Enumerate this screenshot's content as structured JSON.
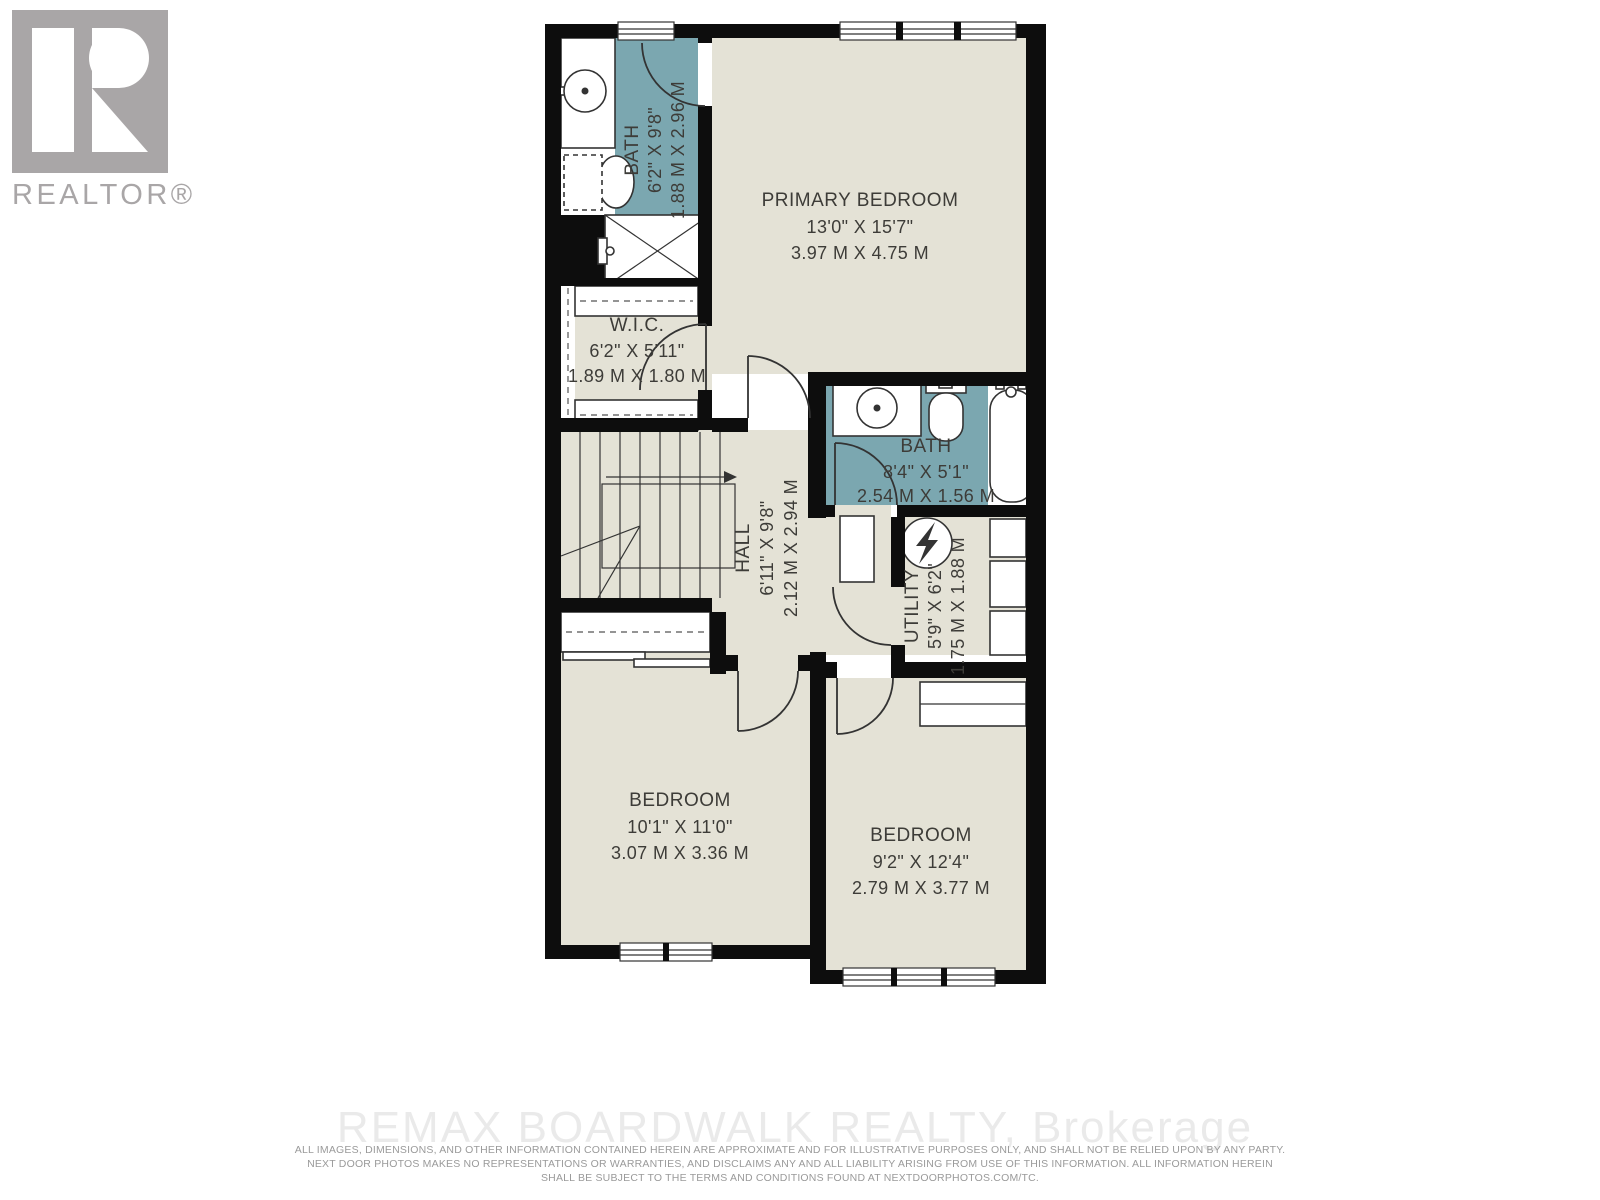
{
  "logo": {
    "letter": "R",
    "label": "REALTOR®"
  },
  "rooms": {
    "bath1": {
      "name": "BATH",
      "imperial": "6'2\" X 9'8\"",
      "metric": "1.88 M X 2.96 M"
    },
    "primary": {
      "name": "PRIMARY BEDROOM",
      "imperial": "13'0\" X 15'7\"",
      "metric": "3.97 M X 4.75 M"
    },
    "wic": {
      "name": "W.I.C.",
      "imperial": "6'2\" X 5'11\"",
      "metric": "1.89 M X 1.80 M"
    },
    "bath2": {
      "name": "BATH",
      "imperial": "8'4\" X 5'1\"",
      "metric": "2.54 M X 1.56 M"
    },
    "hall": {
      "name": "HALL",
      "imperial": "6'11\" X 9'8\"",
      "metric": "2.12 M X 2.94 M"
    },
    "utility": {
      "name": "UTILITY",
      "imperial": "5'9\" X 6'2\"",
      "metric": "1.75 M X 1.88 M"
    },
    "bedroom2": {
      "name": "BEDROOM",
      "imperial": "10'1\" X 11'0\"",
      "metric": "3.07 M X 3.36 M"
    },
    "bedroom3": {
      "name": "BEDROOM",
      "imperial": "9'2\" X 12'4\"",
      "metric": "2.79 M X 3.77 M"
    }
  },
  "watermark": "REMAX BOARDWALK REALTY, Brokerage",
  "disclaimer": {
    "line1": "ALL IMAGES, DIMENSIONS, AND OTHER INFORMATION CONTAINED HEREIN ARE APPROXIMATE AND FOR ILLUSTRATIVE PURPOSES ONLY, AND SHALL NOT BE RELIED UPON BY ANY PARTY.",
    "line2": "NEXT DOOR PHOTOS MAKES NO REPRESENTATIONS OR WARRANTIES, AND DISCLAIMS ANY AND ALL LIABILITY ARISING FROM USE OF THIS INFORMATION. ALL INFORMATION HEREIN",
    "line3": "SHALL BE SUBJECT TO THE TERMS AND CONDITIONS FOUND AT NEXTDOORPHOTOS.COM/TC."
  },
  "colors": {
    "wall": "#0d0d0d",
    "room": "#e4e2d6",
    "bath": "#7ba7b0",
    "line": "#333333",
    "text": "#3d3c38",
    "logo_gray": "#a9a6a7",
    "watermark": "#eaeaea",
    "disclaimer": "#9a9a9a"
  }
}
